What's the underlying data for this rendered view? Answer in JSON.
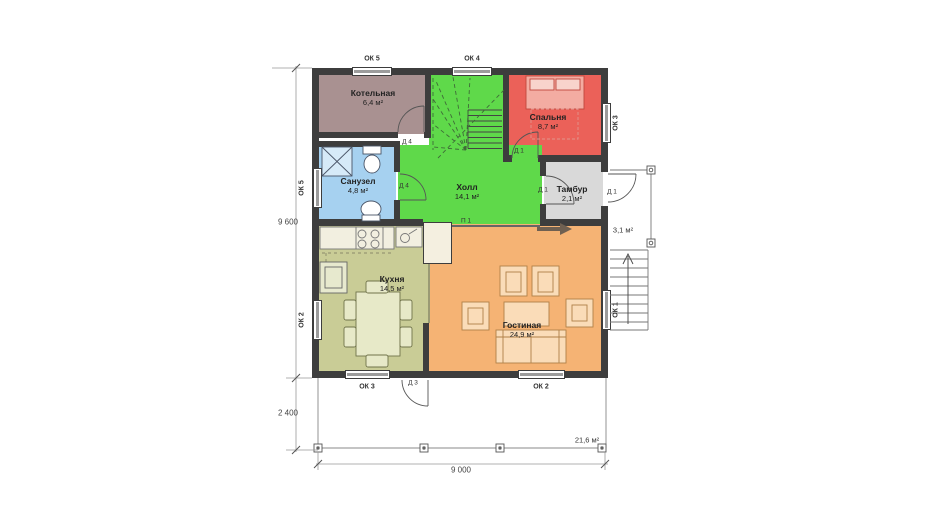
{
  "rooms": {
    "boiler": {
      "name": "Котельная",
      "area": "6,4 м²"
    },
    "bedroom": {
      "name": "Спальня",
      "area": "8,7 м²"
    },
    "bathroom": {
      "name": "Санузел",
      "area": "4,8 м²"
    },
    "hall": {
      "name": "Холл",
      "area": "14,1 м²"
    },
    "vestibule": {
      "name": "Тамбур",
      "area": "2,1 м²"
    },
    "kitchen": {
      "name": "Кухня",
      "area": "14,5 м²"
    },
    "living": {
      "name": "Гостиная",
      "area": "24,9 м²"
    },
    "porch": {
      "area": "3,1 м²"
    },
    "terrace": {
      "area": "21,6 м²"
    }
  },
  "windows": {
    "top_left": "ОК 5",
    "top_center": "ОК 4",
    "left_top": "ОК 5",
    "left_bottom": "ОК 2",
    "right_top": "ОК 3",
    "right_bottom": "ОК 1",
    "bottom_left": "ОК 3",
    "bottom_right": "ОК 2"
  },
  "doors": {
    "boiler": "Д 4",
    "bathroom": "Д 4",
    "bedroom": "Д 1",
    "vestibule_inner": "Д 1",
    "entry": "Д 1",
    "terrace": "Д 3"
  },
  "openings": {
    "hall_living": "П 1"
  },
  "dimensions": {
    "house_height": "9 600",
    "terrace_depth": "2 400",
    "house_width": "9 000"
  },
  "colors": {
    "wall": "#3d3d3d",
    "boiler": "#a99191",
    "bedroom": "#eb6159",
    "bathroom": "#a6d1f0",
    "hall": "#5fd94a",
    "vestibule": "#d9d9d9",
    "kitchen": "#c9cc96",
    "living": "#f5b374",
    "bed": "#f3aca2",
    "kitchen_furniture": "#e7e9c8",
    "living_furniture": "#fadcb8"
  }
}
